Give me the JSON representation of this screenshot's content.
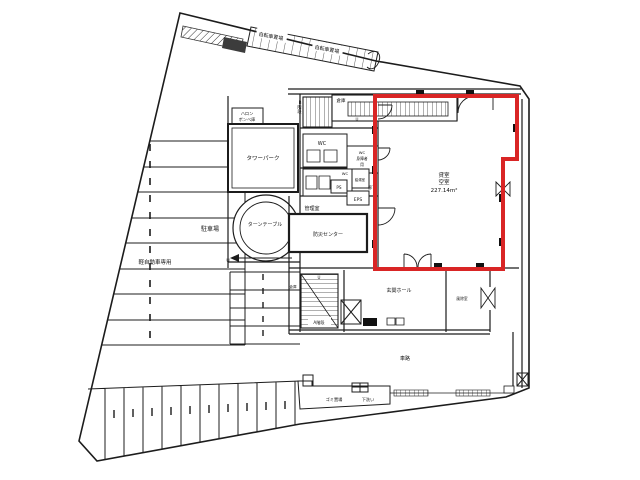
{
  "document": {
    "type": "building-floor-plan",
    "highlight_color": "#d92525",
    "line_color": "#1c1c1c",
    "background": "#ffffff"
  },
  "labels": {
    "bicycle_a": "自転車置場",
    "bicycle_b": "自転車置場",
    "halon1": "ハロン",
    "halon2": "ボンベ庫",
    "tower_park": "タワーパーク",
    "turntable": "ターンテーブル",
    "parking": "駐車場",
    "kei_only": "軽自動車専用",
    "stairs_b": "B階段",
    "storage_b": "倉庫",
    "wc1": "WC",
    "wc_acc1": "WC",
    "wc_acc2": "身障者",
    "wc_acc3": "用",
    "wc2": "WC",
    "kyuto": "給湯室",
    "ps": "PS",
    "eps": "EPS",
    "rouka": "廊下",
    "kanri": "管理室",
    "bousai": "防災センター",
    "storage_a": "倉庫",
    "stairs_a": "A階段",
    "u1": "U",
    "u2": "U",
    "u3": "U",
    "hall": "玄関ホール",
    "fujyo": "風除室",
    "sharo": "車路",
    "gomi": "ゴミ置場",
    "shitaarai": "下洗い",
    "room": {
      "name1": "貸室",
      "name2": "空室",
      "area": "227.14m²"
    }
  }
}
